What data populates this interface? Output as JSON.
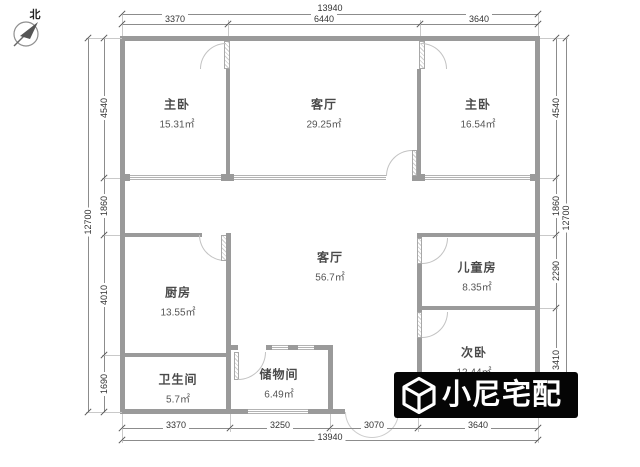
{
  "compass": {
    "label": "北"
  },
  "plan": {
    "rooms": [
      {
        "name": "主卧",
        "area": "15.31㎡"
      },
      {
        "name": "客厅",
        "area": "29.25㎡"
      },
      {
        "name": "主卧",
        "area": "16.54㎡"
      },
      {
        "name": "客厅",
        "area": "56.7㎡"
      },
      {
        "name": "儿童房",
        "area": "8.35㎡"
      },
      {
        "name": "厨房",
        "area": "13.55㎡"
      },
      {
        "name": "卫生间",
        "area": "5.7㎡"
      },
      {
        "name": "储物间",
        "area": "6.49㎡"
      },
      {
        "name": "次卧",
        "area": "12.44㎡"
      }
    ],
    "wall_color": "#9a9a9a",
    "watermark_bg": "#050505"
  },
  "dimensions": {
    "top": {
      "total": "13940",
      "segments": [
        "3370",
        "6440",
        "3640"
      ]
    },
    "bottom": {
      "total": "13940",
      "segments": [
        "3370",
        "3250",
        "3070",
        "3640"
      ]
    },
    "left": {
      "total": "12700",
      "segments": [
        "4540",
        "1860",
        "4010",
        "1690"
      ]
    },
    "right": {
      "total": "12700",
      "segments": [
        "4540",
        "1860",
        "2290",
        "3410"
      ]
    }
  },
  "watermark": {
    "text": "小尼宅配"
  }
}
